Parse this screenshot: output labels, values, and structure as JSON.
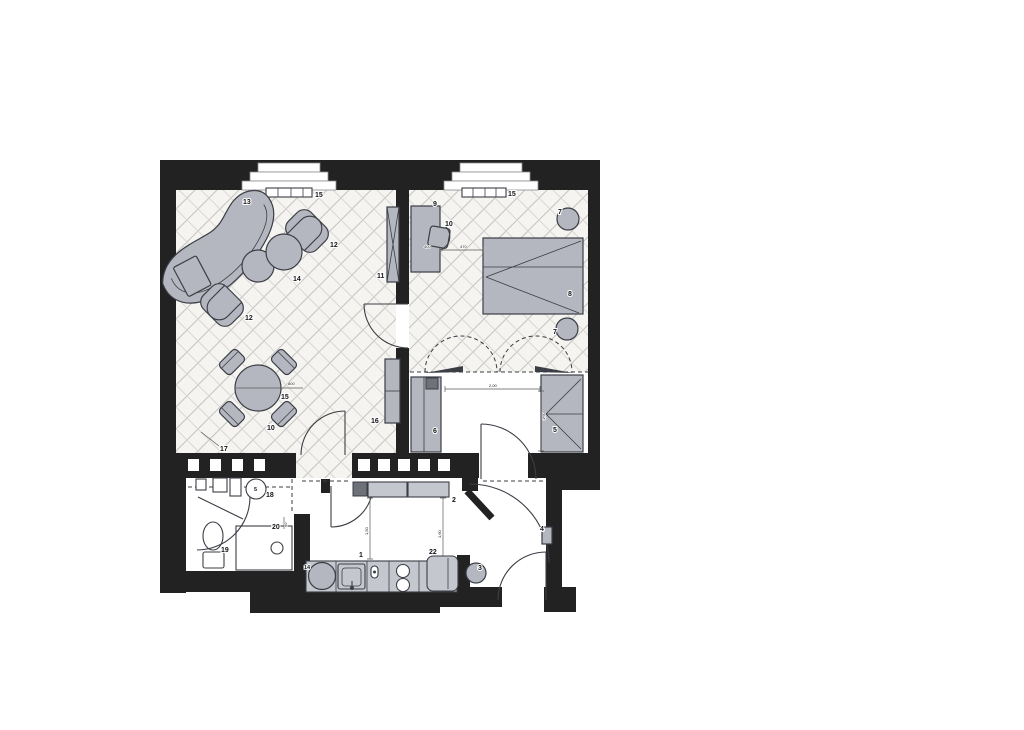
{
  "document": {
    "kind": "scanned apartment floor plan",
    "sections": [
      "living room",
      "bedroom",
      "bathroom",
      "kitchen corridor",
      "entry hall"
    ]
  },
  "colors": {
    "wall": "#222222",
    "outline": "#3b3e45",
    "furniture": "#b4b7bf",
    "counter": "#c4c7ce",
    "darkblock": "#6e7178",
    "hatch": "#c6c4c0",
    "hatch2": "#dbd9d5",
    "floorbg": "#f5f4f1",
    "dimline": "#5a5a5a",
    "text": "#15151a"
  },
  "labels": [
    {
      "name": "sofa",
      "text": "13"
    },
    {
      "name": "armchair-right",
      "text": "12"
    },
    {
      "name": "poufs",
      "text": "14"
    },
    {
      "name": "armchair-left",
      "text": "12"
    },
    {
      "name": "radiator-living",
      "text": "15"
    },
    {
      "name": "table-leader",
      "text": "15"
    },
    {
      "name": "dining-chairs",
      "text": "10"
    },
    {
      "name": "wall-cabinet-tall",
      "text": "11"
    },
    {
      "name": "cabinet-low",
      "text": "16"
    },
    {
      "name": "floor-leader",
      "text": "17"
    },
    {
      "name": "desk",
      "text": "9"
    },
    {
      "name": "desk-chair",
      "text": "10"
    },
    {
      "name": "radiator-bedroom",
      "text": "15"
    },
    {
      "name": "side-table-top",
      "text": "7"
    },
    {
      "name": "bed",
      "text": "8"
    },
    {
      "name": "side-table-bottom",
      "text": "7"
    },
    {
      "name": "wardrobe-left",
      "text": "6"
    },
    {
      "name": "wardrobe-corner",
      "text": "5"
    },
    {
      "name": "boiler",
      "text": "18"
    },
    {
      "name": "toilet",
      "text": "19"
    },
    {
      "name": "shower",
      "text": "20"
    },
    {
      "name": "kitchen-counter",
      "text": "1"
    },
    {
      "name": "fridge",
      "text": "22"
    },
    {
      "name": "hall-cabinets",
      "text": "2"
    },
    {
      "name": "stool",
      "text": "3"
    },
    {
      "name": "wall-unit-entry",
      "text": "4"
    },
    {
      "name": "kitchen-sink",
      "text": "14"
    },
    {
      "name": "boiler-symbol",
      "text": "5"
    }
  ],
  "dimensions": [
    {
      "name": "table-diameter",
      "text": "800"
    },
    {
      "name": "desk-dim-a",
      "text": "400"
    },
    {
      "name": "desk-dim-b",
      "text": "470"
    },
    {
      "name": "dressing-width",
      "text": "2,00"
    },
    {
      "name": "dressing-depth",
      "text": "1,60"
    },
    {
      "name": "kitchen-dim-a",
      "text": "1,50"
    },
    {
      "name": "kitchen-dim-b",
      "text": "1,60"
    },
    {
      "name": "shower-dim",
      "text": "90"
    }
  ]
}
